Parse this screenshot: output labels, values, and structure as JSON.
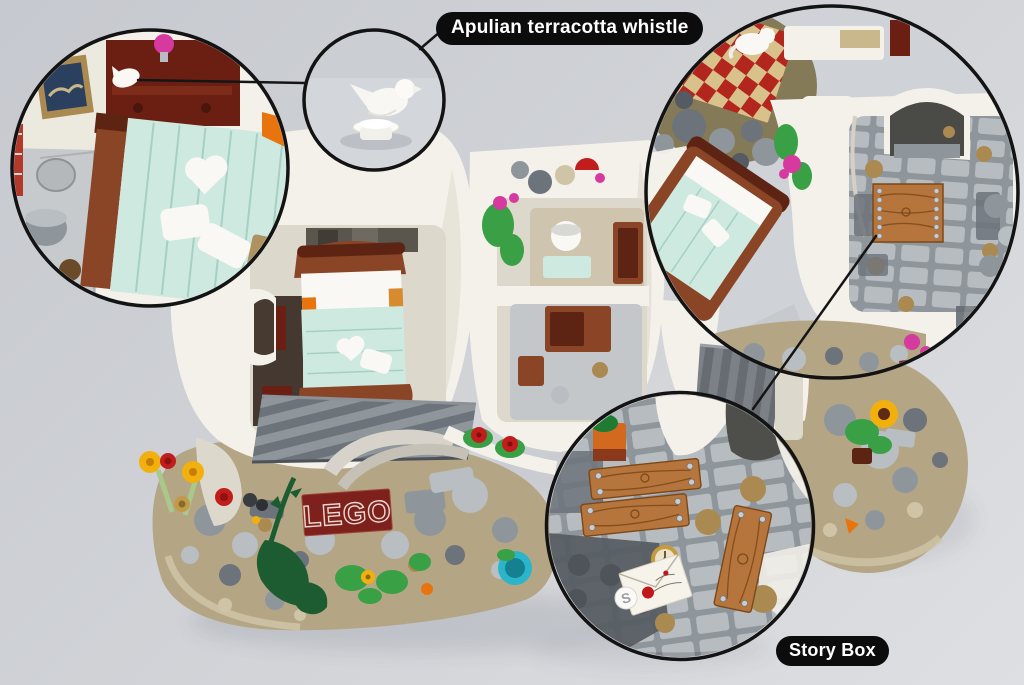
{
  "scene": {
    "title_callout": "Apulian terracotta whistle",
    "story_callout": "Story Box",
    "lego_brick_text": "LEGO",
    "s_tile_glyph": "S"
  },
  "icons": {
    "whistle_figure": "bird-whistle-icon",
    "cat_figure": "white-cat-icon",
    "envelope": "love-letter-icon",
    "compass": "compass-tile-icon"
  },
  "colors": {
    "bg_top": "#c6c9cf",
    "bg_mid": "#d2d4d8",
    "bg_bottom": "#dedfe2",
    "callout_bg": "#0c0c0c",
    "callout_text": "#ffffff",
    "outline": "#131313",
    "wall": "#f4f1ea",
    "wall_shade": "#ddd8cc",
    "white": "#f9f8f4",
    "mint": "#cde9e0",
    "mint_line": "#a6d0c4",
    "red_brown": "#8a4426",
    "dark_red_brown": "#5d2413",
    "maroon": "#6b1f12",
    "orange": "#d88a2e",
    "wood": "#b5753c",
    "wood_dark": "#7c4818",
    "stone_l": "#b9bec2",
    "stone_m": "#8f969b",
    "stone_d": "#6d737a",
    "stone_dd": "#555b62",
    "tan": "#b4a685",
    "tan_l": "#cfc4a6",
    "tan_c": "#ab8a52",
    "olive": "#857a58",
    "green": "#3aa046",
    "dark_green": "#1d5c31",
    "stem": "#a9c98b",
    "red": "#c11d1d",
    "yellow": "#f2b00e",
    "orange_f": "#e8740e",
    "magenta": "#d63a9e",
    "teal": "#2ab5cb",
    "lego_red": "#7e211c",
    "lego_text": "#e9d9d2",
    "checker_red": "#b3261e",
    "checker_cream": "#d8c18b",
    "gold": "#c79a3a",
    "cream": "#ece3cc",
    "envelope_paper": "#f6f3ea",
    "seal_red": "#c0161c",
    "silver": "#c9cdd1"
  }
}
